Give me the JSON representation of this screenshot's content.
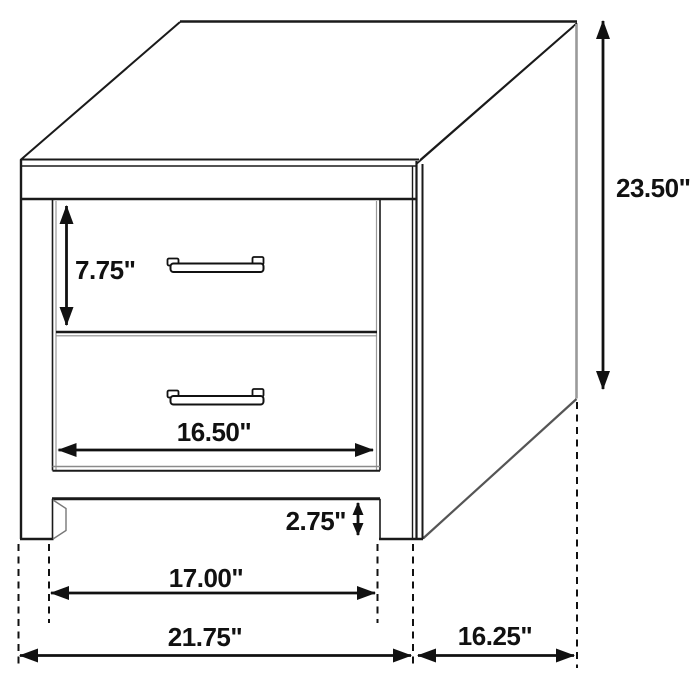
{
  "diagram": {
    "subject": "two-drawer nightstand dimension drawing",
    "background": "#ffffff",
    "line_color": "#1a1a1a",
    "dimensions": {
      "overall_height": "23.50\"",
      "top_drawer_height": "7.75\"",
      "drawer_width": "16.50\"",
      "leg_height": "2.75\"",
      "inner_leg_span": "17.00\"",
      "overall_width": "21.75\"",
      "depth": "16.25\""
    }
  }
}
